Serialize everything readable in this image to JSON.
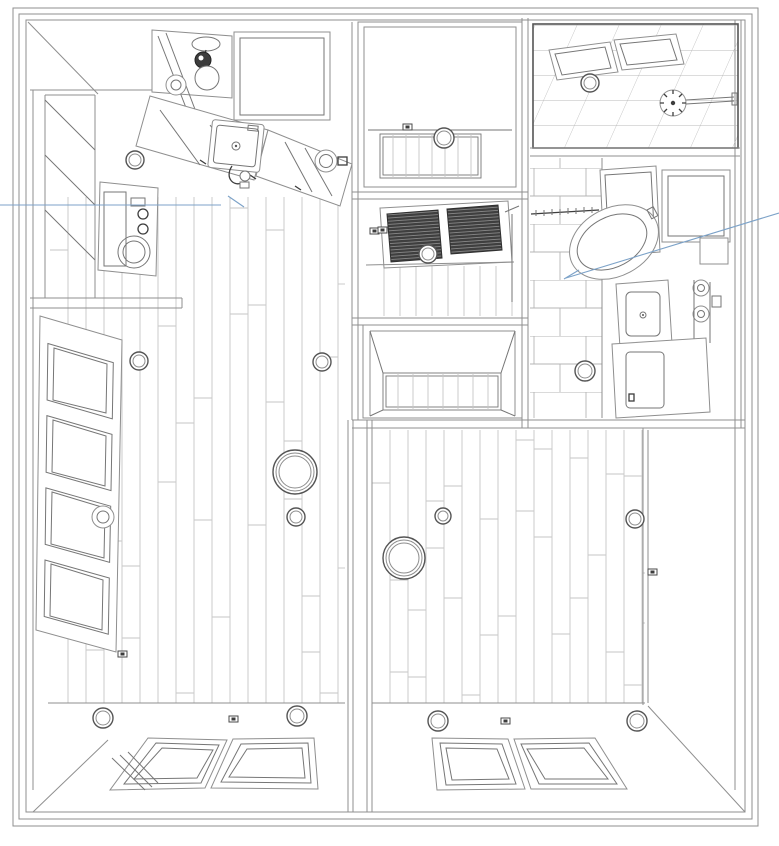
{
  "colors": {
    "background": "#ffffff",
    "wall_line": "#8f8f8f",
    "detail_line": "#767676",
    "dark_line": "#3d3d3d",
    "floor_line": "#c6c6c6",
    "tile_line": "#b5b5b5",
    "blind_fill": "#3f3f3f",
    "blind_stripe": "#9a9a9a",
    "leader_line": "#7ca2c8"
  },
  "lights": [
    {
      "name": "kitchen-spot-light",
      "x": 135,
      "y": 160,
      "r": 9
    },
    {
      "name": "entry-ceiling-light",
      "x": 444,
      "y": 138,
      "r": 10
    },
    {
      "name": "hall-ceiling-light",
      "x": 428,
      "y": 254,
      "r": 9
    },
    {
      "name": "shower-ceiling-light",
      "x": 590,
      "y": 83,
      "r": 9
    },
    {
      "name": "bathroom-ceiling-light",
      "x": 585,
      "y": 371,
      "r": 10
    },
    {
      "name": "living-spot-light-nw",
      "x": 139,
      "y": 361,
      "r": 9
    },
    {
      "name": "living-spot-light-ne",
      "x": 322,
      "y": 362,
      "r": 9
    },
    {
      "name": "living-pendant-light",
      "x": 295,
      "y": 472,
      "r": 22,
      "double": true
    },
    {
      "name": "living-pendant-small",
      "x": 296,
      "y": 517,
      "r": 9
    },
    {
      "name": "living-spot-light-sw",
      "x": 103,
      "y": 718,
      "r": 10
    },
    {
      "name": "living-spot-light-se",
      "x": 297,
      "y": 716,
      "r": 10
    },
    {
      "name": "bedroom-pendant-light",
      "x": 404,
      "y": 558,
      "r": 21,
      "double": true
    },
    {
      "name": "bedroom-spot-light-n",
      "x": 443,
      "y": 516,
      "r": 8
    },
    {
      "name": "bedroom-spot-light-e",
      "x": 635,
      "y": 519,
      "r": 9
    },
    {
      "name": "bedroom-spot-light-sw",
      "x": 438,
      "y": 721,
      "r": 10
    },
    {
      "name": "bedroom-spot-light-se",
      "x": 637,
      "y": 721,
      "r": 10
    }
  ],
  "leaders": [
    {
      "name": "left-callout-leader",
      "segments": [
        [
          [
            0,
            205
          ],
          [
            221,
            205
          ]
        ],
        [
          [
            228,
            196
          ],
          [
            244,
            207
          ]
        ]
      ]
    },
    {
      "name": "right-callout-leader",
      "segments": [
        [
          [
            779,
            213
          ],
          [
            566,
            278
          ]
        ],
        [
          [
            564,
            279
          ],
          [
            579,
            270
          ]
        ]
      ]
    }
  ],
  "floors": [
    {
      "name": "living-room",
      "x1": 50,
      "x2": 345,
      "y1": 197,
      "y2": 703,
      "gap": 18,
      "seams": true
    },
    {
      "name": "bedroom",
      "x1": 372,
      "x2": 645,
      "y1": 430,
      "y2": 703,
      "gap": 18,
      "seams": true
    },
    {
      "name": "entry-strip",
      "x1": 380,
      "x2": 481,
      "y1": 134,
      "y2": 178,
      "gap": 13,
      "frame": true
    },
    {
      "name": "hall",
      "x1": 368,
      "x2": 514,
      "y1": 266,
      "y2": 316,
      "gap": 16
    },
    {
      "name": "closet",
      "x1": 383,
      "x2": 501,
      "y1": 373,
      "y2": 410,
      "gap": 15,
      "frame": true
    }
  ],
  "switches": [
    {
      "name": "entry-switch",
      "x": 403,
      "y": 124
    },
    {
      "name": "hall-switch-a",
      "x": 370,
      "y": 228
    },
    {
      "name": "hall-switch-b",
      "x": 378,
      "y": 227
    },
    {
      "name": "living-switch-s",
      "x": 229,
      "y": 716
    },
    {
      "name": "bedroom-switch-s",
      "x": 501,
      "y": 718
    },
    {
      "name": "bedroom-door-handle",
      "x": 648,
      "y": 569
    },
    {
      "name": "living-door-mark",
      "x": 118,
      "y": 651
    }
  ]
}
